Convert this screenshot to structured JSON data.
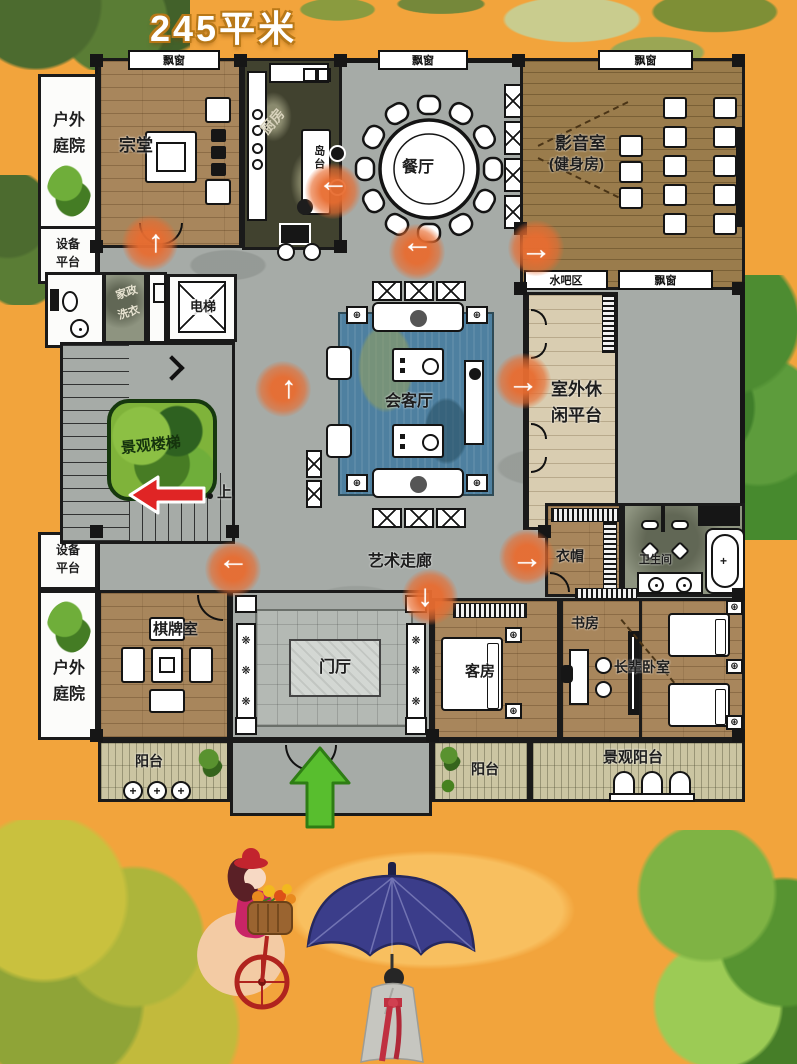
{
  "title": "245平米",
  "labels": {
    "bay_window": "飘窗",
    "water_bar": "水吧区",
    "stairs_up": "上"
  },
  "rooms": {
    "zongtang": "宗堂",
    "kitchen": "厨房",
    "island": "岛台",
    "dining": "餐厅",
    "media1": "影音室",
    "media2": "(健身房)",
    "laundry1": "家政",
    "laundry2": "洗衣",
    "elevator": "电梯",
    "stairs": "景观楼梯",
    "living": "会客厅",
    "platform1": "室外休",
    "platform2": "闲平台",
    "corridor": "艺术走廊",
    "cloak": "衣帽",
    "bath": "卫生间",
    "chess": "棋牌室",
    "foyer": "门厅",
    "guest": "客房",
    "study": "书房",
    "elder": "长辈卧室",
    "balcony": "阳台",
    "scenic_balcony": "景观阳台",
    "courtyard1": "户外",
    "courtyard2": "庭院",
    "equip1": "设备",
    "equip2": "平台"
  },
  "colors": {
    "background": "#F2A43C",
    "plan_gray": "#A6ABA7",
    "wood": "#A8865C",
    "flow_arrow_orange": "#E86C30",
    "red_arrow": "#E02525",
    "green_arrow": "#58BE2E",
    "rug_blue": "#4E80A0",
    "stairs_island_green": "#7FB33A",
    "platform_beige": "#D9CDB1",
    "balcony_olive": "#CBC5A2"
  }
}
